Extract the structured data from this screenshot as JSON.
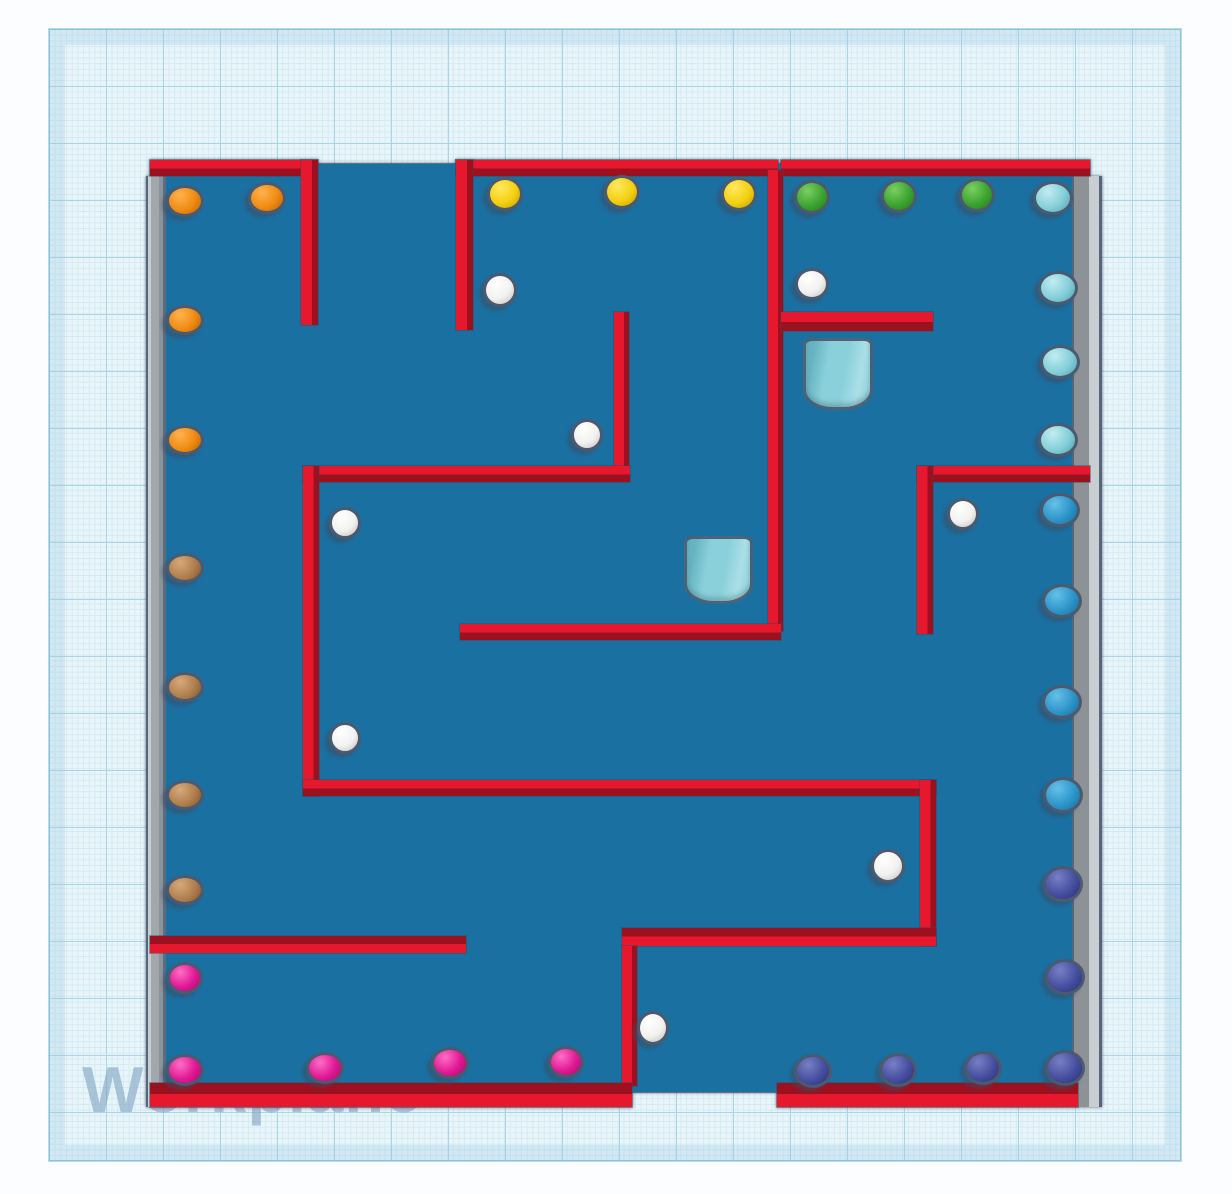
{
  "app": {
    "watermark_label": "Workplane"
  },
  "colors": {
    "canvas_bg": "#fbfdfe",
    "plane_bg": "#eaf5fa",
    "grid_minor": "#d2eaf4",
    "grid_major": "#a8d6e6",
    "floor": "#1b70a2",
    "red_bright": "#e5182e",
    "red_dark": "#9c1120",
    "watermark": "#7da1bf",
    "cyl_base": "#8ad0da",
    "cyl_light": "#abdfe6",
    "cyl_dark": "#66b4c1"
  },
  "sphere_palette": {
    "orange": {
      "l": "#ffb24d",
      "b": "#ef8b13",
      "d": "#b96607"
    },
    "yellow": {
      "l": "#ffe95e",
      "b": "#f3d011",
      "d": "#bda005"
    },
    "green": {
      "l": "#7ccf62",
      "b": "#3ba430",
      "d": "#267c1e"
    },
    "ltcyan": {
      "l": "#c2ecf0",
      "b": "#84cfd9",
      "d": "#55a4b2"
    },
    "mdblue": {
      "l": "#66c0e8",
      "b": "#2d95c9",
      "d": "#1a6e9b"
    },
    "navy": {
      "l": "#7780c4",
      "b": "#454f9f",
      "d": "#2a3272"
    },
    "magenta": {
      "l": "#ff6ec4",
      "b": "#e01895",
      "d": "#a80c6e"
    },
    "brown": {
      "l": "#d6a97a",
      "b": "#b17f4e",
      "d": "#7f5832"
    },
    "white": {
      "l": "#ffffff",
      "b": "#f1f1ef",
      "d": "#bfc2c2"
    }
  },
  "scene": {
    "floor_rects": [
      [
        163,
        164,
        912,
        928
      ]
    ],
    "gray_walls": [
      {
        "side": "left",
        "rect": [
          146,
          176,
          20,
          931
        ]
      },
      {
        "side": "right",
        "rect": [
          1072,
          176,
          30,
          931
        ]
      }
    ],
    "red_walls": [
      {
        "dir": "h",
        "shade": "bright",
        "rect": [
          150,
          160,
          167,
          16
        ]
      },
      {
        "dir": "h",
        "shade": "bright",
        "rect": [
          456,
          160,
          322,
          16
        ]
      },
      {
        "dir": "h",
        "shade": "bright",
        "rect": [
          781,
          160,
          309,
          16
        ]
      },
      {
        "dir": "v",
        "rect": [
          301,
          160,
          17,
          165
        ]
      },
      {
        "dir": "v",
        "rect": [
          456,
          160,
          17,
          170
        ]
      },
      {
        "dir": "v",
        "rect": [
          614,
          312,
          15,
          158
        ]
      },
      {
        "dir": "h",
        "shade": "bright",
        "rect": [
          303,
          466,
          327,
          16
        ]
      },
      {
        "dir": "v",
        "rect": [
          303,
          466,
          16,
          330
        ]
      },
      {
        "dir": "h",
        "shade": "bright",
        "rect": [
          303,
          780,
          633,
          16
        ]
      },
      {
        "dir": "v",
        "rect": [
          920,
          780,
          16,
          166
        ]
      },
      {
        "dir": "h",
        "shade": "dark",
        "rect": [
          622,
          928,
          314,
          18
        ]
      },
      {
        "dir": "v",
        "rect": [
          622,
          946,
          15,
          140
        ]
      },
      {
        "dir": "h",
        "shade": "dark",
        "rect": [
          150,
          936,
          316,
          17
        ]
      },
      {
        "dir": "v",
        "rect": [
          768,
          170,
          15,
          461
        ]
      },
      {
        "dir": "h",
        "shade": "bright",
        "rect": [
          460,
          624,
          321,
          16
        ]
      },
      {
        "dir": "h",
        "shade": "bright",
        "rect": [
          781,
          312,
          152,
          19
        ]
      },
      {
        "dir": "h",
        "shade": "bright",
        "rect": [
          917,
          466,
          173,
          16
        ]
      },
      {
        "dir": "v",
        "rect": [
          917,
          466,
          16,
          168
        ]
      },
      {
        "dir": "h",
        "shade": "dark",
        "rect": [
          150,
          1083,
          482,
          24
        ]
      },
      {
        "dir": "h",
        "shade": "dark",
        "rect": [
          777,
          1083,
          301,
          24
        ]
      }
    ],
    "cylinders": [
      {
        "rect": [
          803,
          338,
          70,
          72
        ]
      },
      {
        "rect": [
          684,
          536,
          69,
          68
        ]
      }
    ],
    "spheres": [
      [
        185,
        201,
        19,
        16,
        "orange"
      ],
      [
        267,
        198,
        19,
        16,
        "orange"
      ],
      [
        185,
        320,
        19,
        15,
        "orange"
      ],
      [
        185,
        440,
        19,
        15,
        "orange"
      ],
      [
        185,
        568,
        19,
        15,
        "brown"
      ],
      [
        185,
        687,
        19,
        15,
        "brown"
      ],
      [
        185,
        795,
        19,
        15,
        "brown"
      ],
      [
        185,
        890,
        19,
        15,
        "brown"
      ],
      [
        185,
        978,
        18,
        16,
        "magenta"
      ],
      [
        185,
        1070,
        19,
        16,
        "magenta"
      ],
      [
        325,
        1068,
        19,
        16,
        "magenta"
      ],
      [
        450,
        1063,
        19,
        16,
        "magenta"
      ],
      [
        566,
        1062,
        18,
        16,
        "magenta"
      ],
      [
        505,
        194,
        18,
        17,
        "yellow"
      ],
      [
        622,
        192,
        18,
        17,
        "yellow"
      ],
      [
        739,
        194,
        18,
        17,
        "yellow"
      ],
      [
        812,
        197,
        18,
        17,
        "green"
      ],
      [
        899,
        196,
        18,
        17,
        "green"
      ],
      [
        977,
        195,
        18,
        17,
        "green"
      ],
      [
        1053,
        198,
        20,
        17,
        "ltcyan"
      ],
      [
        1058,
        288,
        20,
        17,
        "ltcyan"
      ],
      [
        1060,
        362,
        20,
        17,
        "ltcyan"
      ],
      [
        1058,
        440,
        20,
        17,
        "ltcyan"
      ],
      [
        1060,
        510,
        20,
        17,
        "mdblue"
      ],
      [
        1062,
        601,
        20,
        17,
        "mdblue"
      ],
      [
        1062,
        702,
        20,
        17,
        "mdblue"
      ],
      [
        1063,
        795,
        20,
        18,
        "mdblue"
      ],
      [
        1063,
        884,
        20,
        18,
        "navy"
      ],
      [
        1065,
        977,
        20,
        18,
        "navy"
      ],
      [
        1065,
        1068,
        20,
        18,
        "navy"
      ],
      [
        813,
        1071,
        19,
        17,
        "navy"
      ],
      [
        898,
        1070,
        19,
        17,
        "navy"
      ],
      [
        983,
        1068,
        19,
        17,
        "navy"
      ],
      [
        500,
        290,
        17,
        17,
        "white"
      ],
      [
        812,
        284,
        17,
        16,
        "white"
      ],
      [
        587,
        435,
        16,
        16,
        "white"
      ],
      [
        345,
        523,
        16,
        16,
        "white"
      ],
      [
        963,
        514,
        16,
        16,
        "white"
      ],
      [
        345,
        738,
        16,
        16,
        "white"
      ],
      [
        888,
        866,
        17,
        17,
        "white"
      ],
      [
        653,
        1028,
        16,
        17,
        "white"
      ]
    ]
  }
}
